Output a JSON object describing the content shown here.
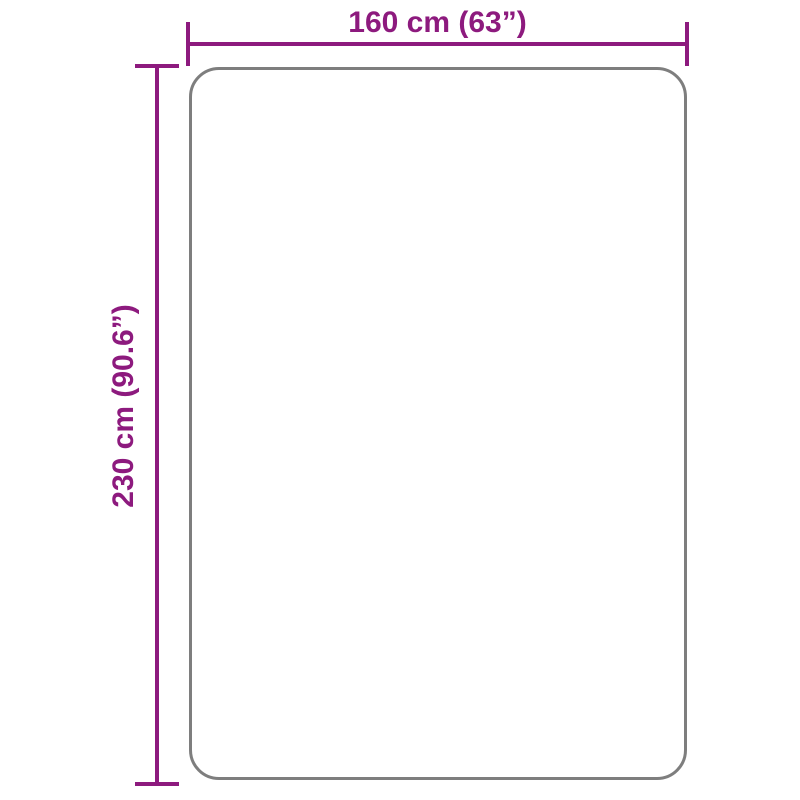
{
  "diagram": {
    "type": "product-dimension-diagram",
    "width_dimension": {
      "label": "160 cm (63”)"
    },
    "height_dimension": {
      "label": "230 cm (90.6”)"
    }
  },
  "colors": {
    "dimension": "#8d1a7e",
    "outline": "#7e7e7e",
    "background": "#ffffff"
  }
}
